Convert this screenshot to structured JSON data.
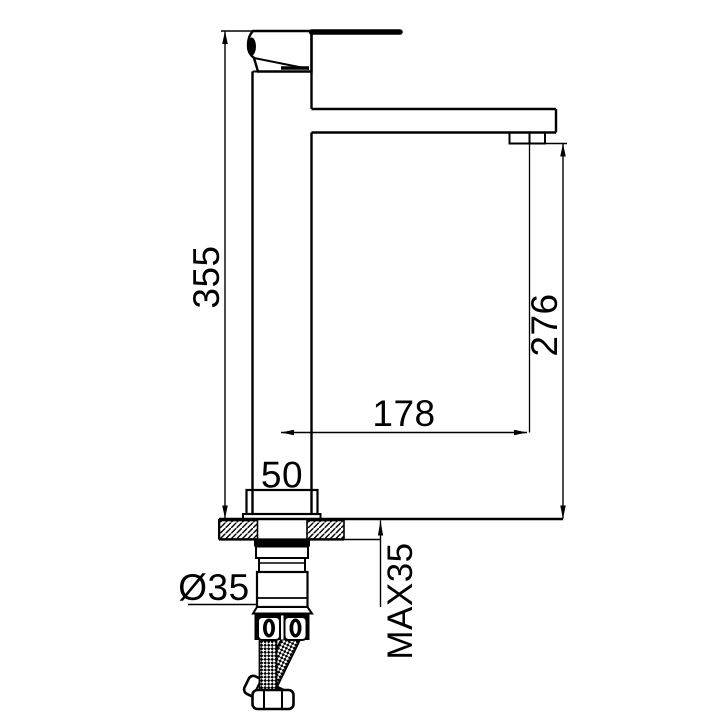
{
  "drawing": {
    "title": "Tall single-lever basin mixer tap — side elevation installation drawing",
    "units": "mm",
    "colors": {
      "line": "#000000",
      "background": "#ffffff"
    },
    "labels": {
      "overall_height": "355",
      "outlet_height": "276",
      "spout_reach": "178",
      "body_width": "50",
      "hole_diameter": "Ø35",
      "max_deck_thickness": "MAX35"
    },
    "values": {
      "overall_height_mm": 355,
      "outlet_height_mm": 276,
      "spout_reach_mm": 178,
      "body_width_mm": 50,
      "hole_diameter_mm": 35,
      "max_deck_thickness_mm": 35
    }
  }
}
